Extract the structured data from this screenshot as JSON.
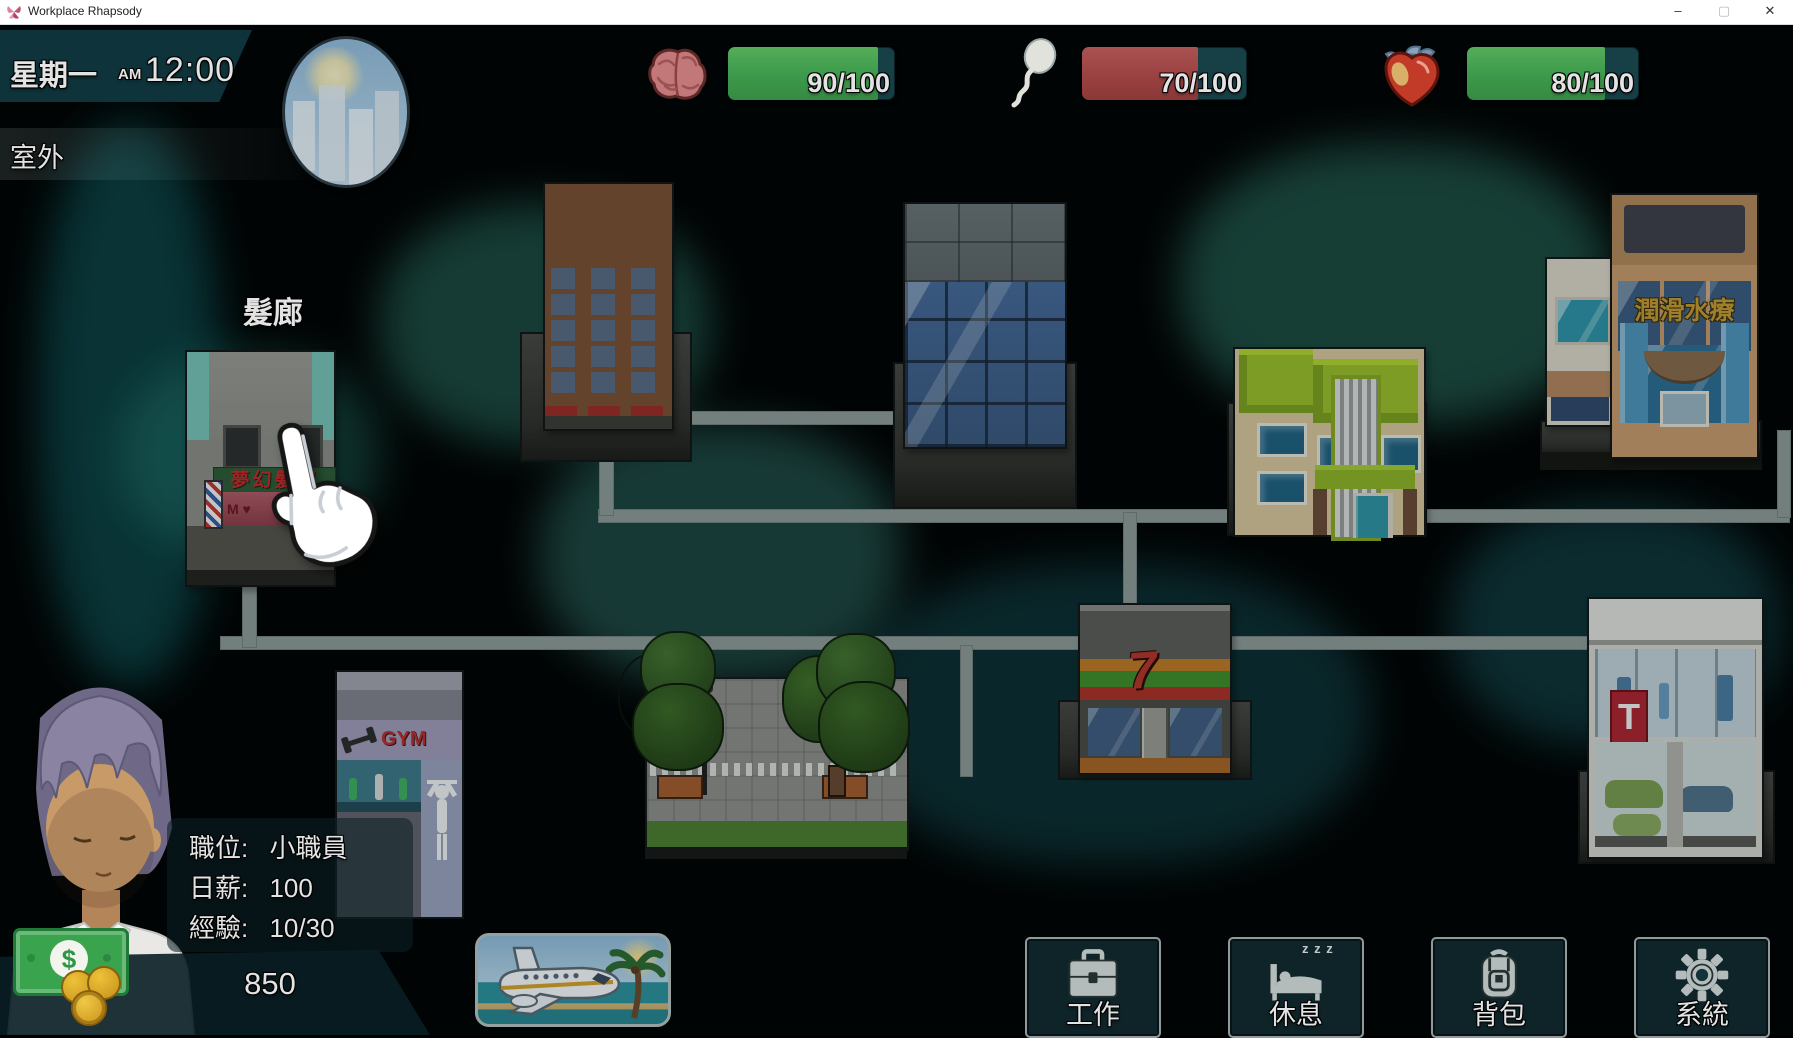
{
  "window": {
    "title": "Workplace Rhapsody",
    "controls": {
      "minimize": "–",
      "maximize": "▢",
      "close": "✕"
    }
  },
  "hud": {
    "day": "星期一",
    "meridiem": "AM",
    "time": "12:00",
    "location": "室外",
    "weather_icon": "sun-over-city",
    "stats": [
      {
        "name": "intellect",
        "icon": "brain-icon",
        "value": "90/100",
        "percent": 90,
        "color": "#3f9d4d"
      },
      {
        "name": "energy",
        "icon": "sperm-icon",
        "value": "70/100",
        "percent": 70,
        "color": "#9c4242"
      },
      {
        "name": "health",
        "icon": "heart-icon",
        "value": "80/100",
        "percent": 80,
        "color": "#3f9d4d"
      }
    ]
  },
  "map": {
    "hair_salon": {
      "label": "髮廊",
      "sign": "夢幻髮廊",
      "graffiti": "M ♥"
    },
    "gym": {
      "sign": "GYM"
    },
    "seven_store": {
      "sign": "7"
    },
    "spa": {
      "sign": "潤滑水療"
    },
    "car_dealer": {
      "sign": "T"
    }
  },
  "player": {
    "position_label": "職位:",
    "position_value": "小職員",
    "salary_label": "日薪:",
    "salary_value": "100",
    "exp_label": "經驗:",
    "exp_value": "10/30",
    "money": "850"
  },
  "actions": [
    {
      "label": "工作",
      "icon": "briefcase-icon"
    },
    {
      "label": "休息",
      "icon": "bed-icon",
      "zzz": "z z z"
    },
    {
      "label": "背包",
      "icon": "backpack-icon"
    },
    {
      "label": "系統",
      "icon": "gear-icon"
    }
  ],
  "colors": {
    "bar_green": "#3f9d4d",
    "bar_red": "#9c4242",
    "path_gray": "#8f9a98",
    "banner_teal": "#113c44",
    "spa_sign_gold": "#c49a33",
    "salon_sign_red": "#c42a2a"
  }
}
